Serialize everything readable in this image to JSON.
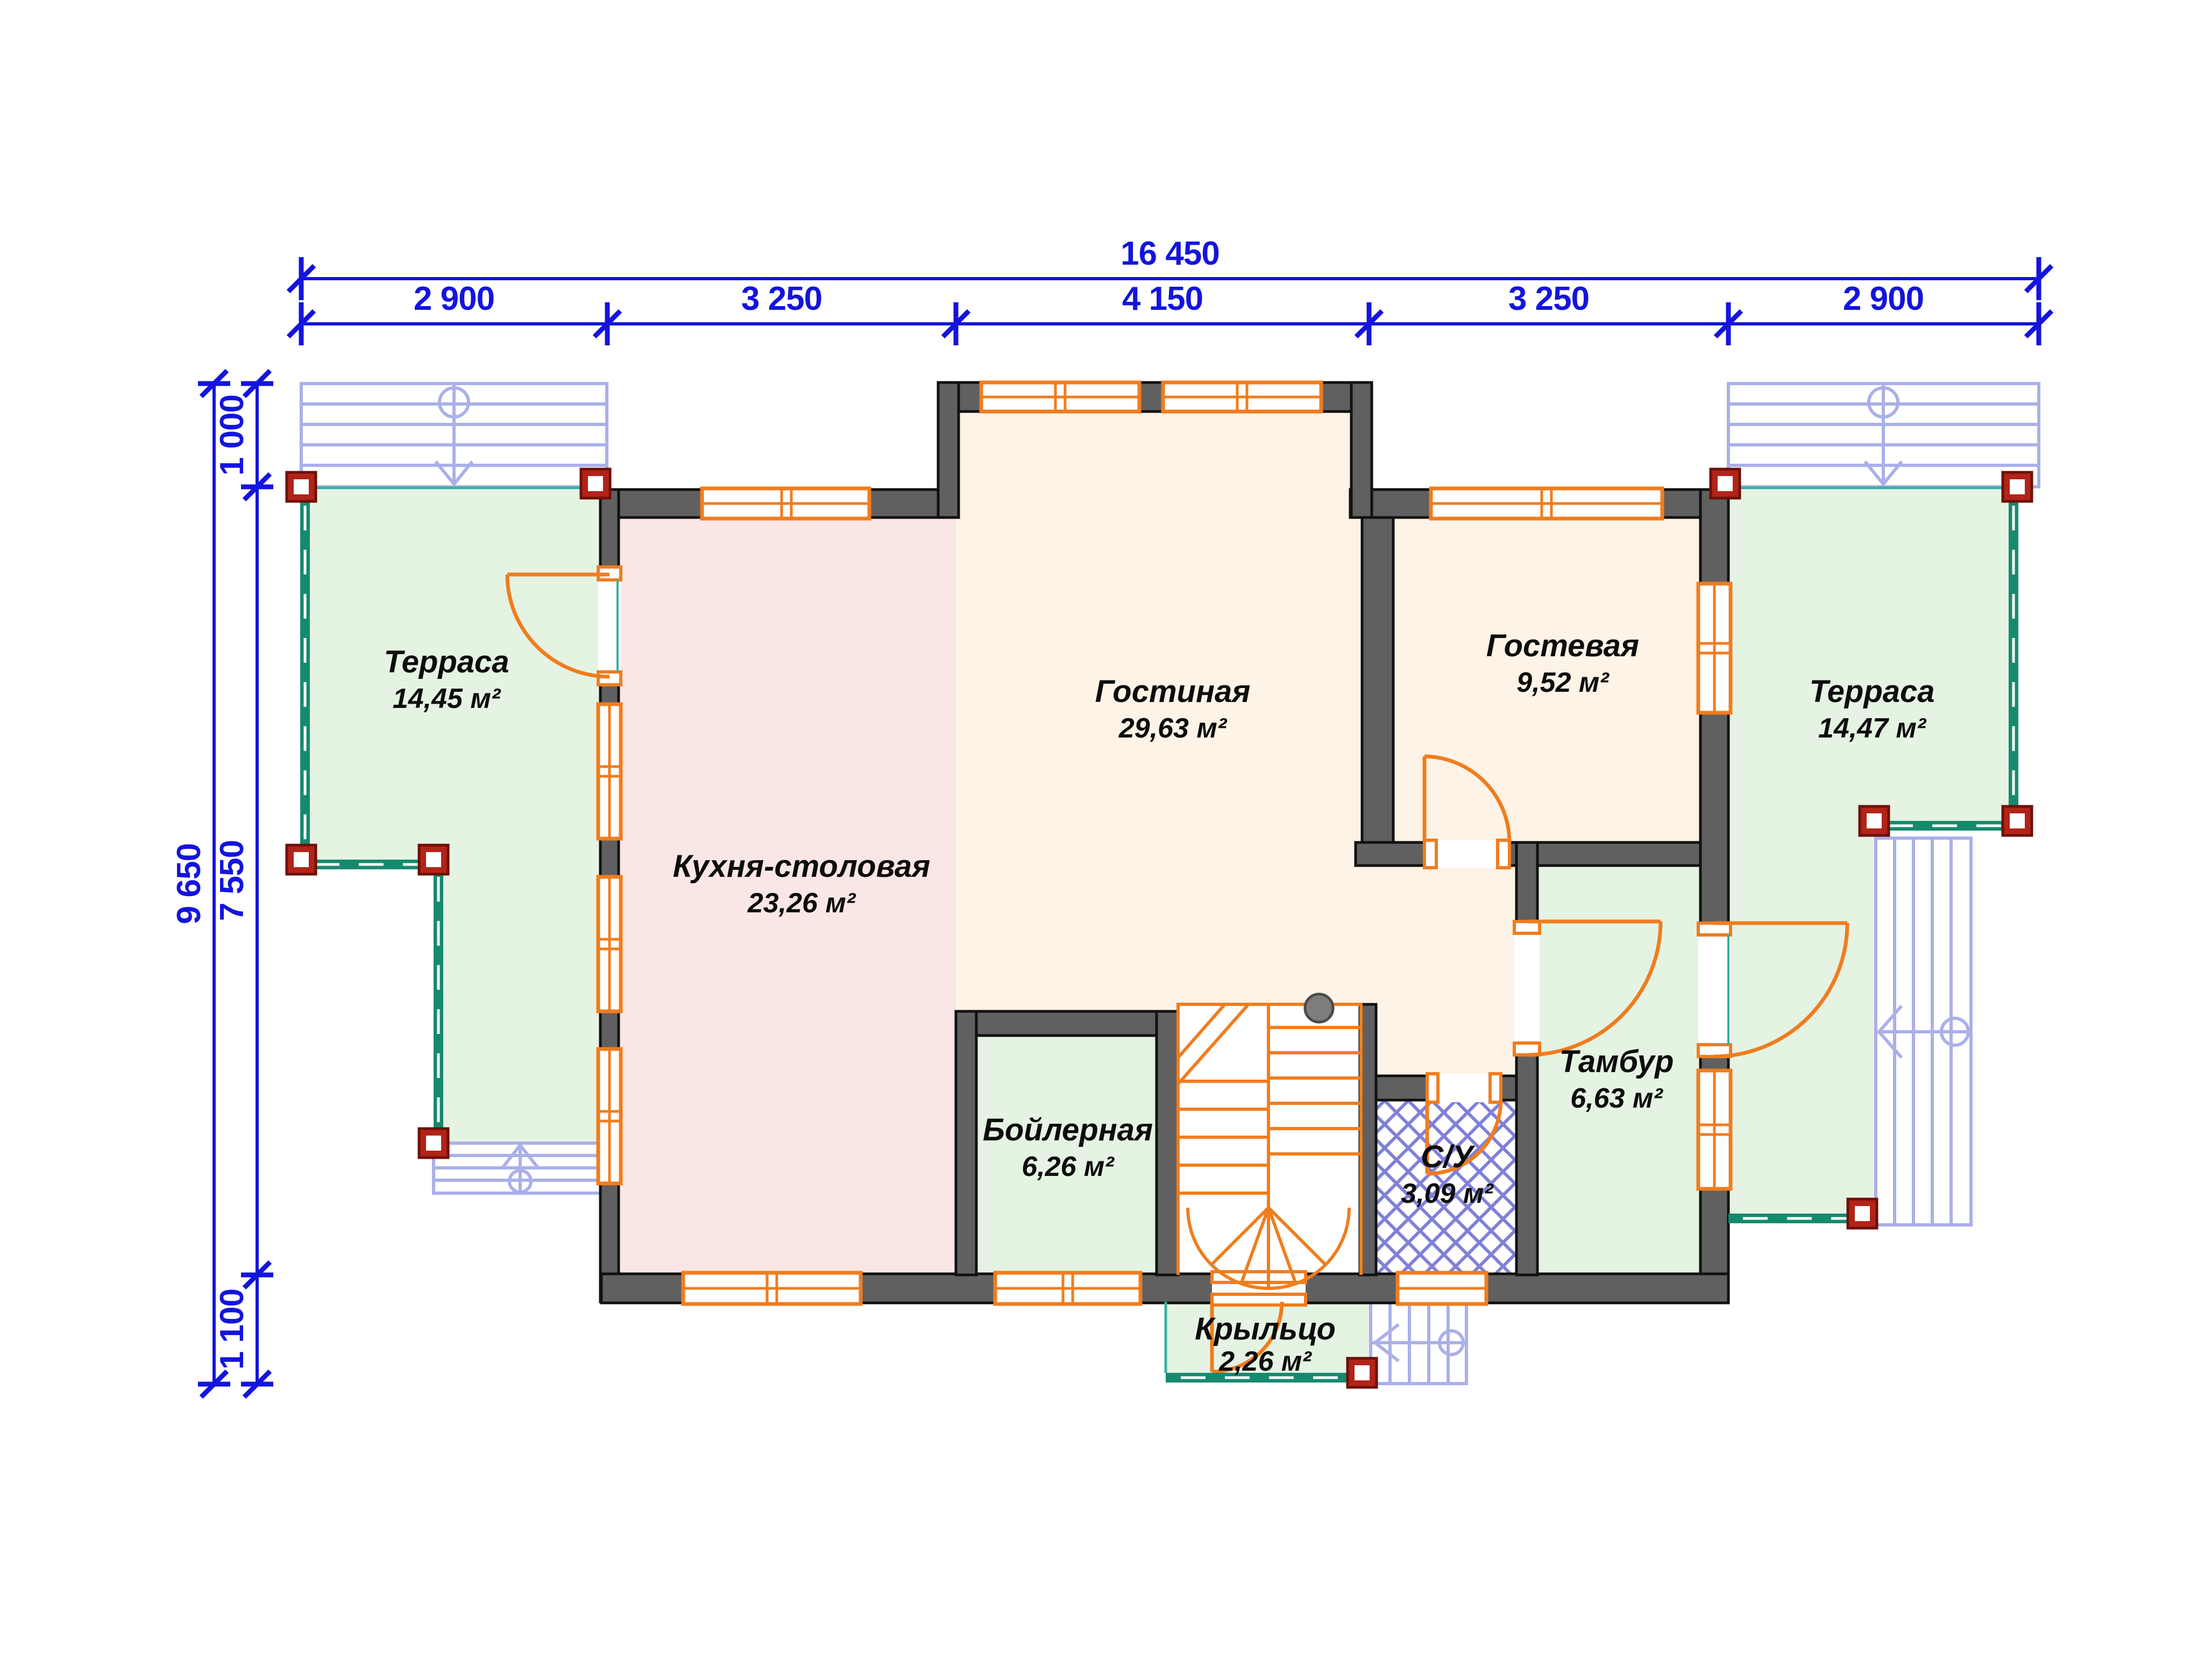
{
  "dimensions": {
    "total_width": "16 450",
    "width_segments": [
      "2 900",
      "3 250",
      "4 150",
      "3 250",
      "2 900"
    ],
    "total_height": "9 650",
    "height_segments": [
      "1 000",
      "7 550",
      "1 100"
    ]
  },
  "rooms": [
    {
      "key": "terrace_left",
      "name": "Терраса",
      "area": "14,45 м²"
    },
    {
      "key": "kitchen",
      "name": "Кухня-столовая",
      "area": "23,26 м²"
    },
    {
      "key": "living",
      "name": "Гостиная",
      "area": "29,63 м²"
    },
    {
      "key": "guest",
      "name": "Гостевая",
      "area": "9,52 м²"
    },
    {
      "key": "terrace_right",
      "name": "Терраса",
      "area": "14,47 м²"
    },
    {
      "key": "boiler",
      "name": "Бойлерная",
      "area": "6,26 м²"
    },
    {
      "key": "wc",
      "name": "С/У",
      "area": "3,09 м²"
    },
    {
      "key": "tambour",
      "name": "Тамбур",
      "area": "6,63 м²"
    },
    {
      "key": "porch",
      "name": "Крыльцо",
      "area": "2,26 м²"
    }
  ],
  "colors": {
    "dimension_blue": "#1414dd",
    "wall_gray": "#606060",
    "joinery_orange": "#f07d1e",
    "terrace_green": "#e5f3e3",
    "kitchen_pink": "#fae7e5",
    "living_cream": "#fdf3e6",
    "railing_teal": "#168a6e",
    "post_red": "#b22318",
    "outdoor_stair_lilac": "#aab0e8",
    "hatch_blue": "#8080d8"
  }
}
